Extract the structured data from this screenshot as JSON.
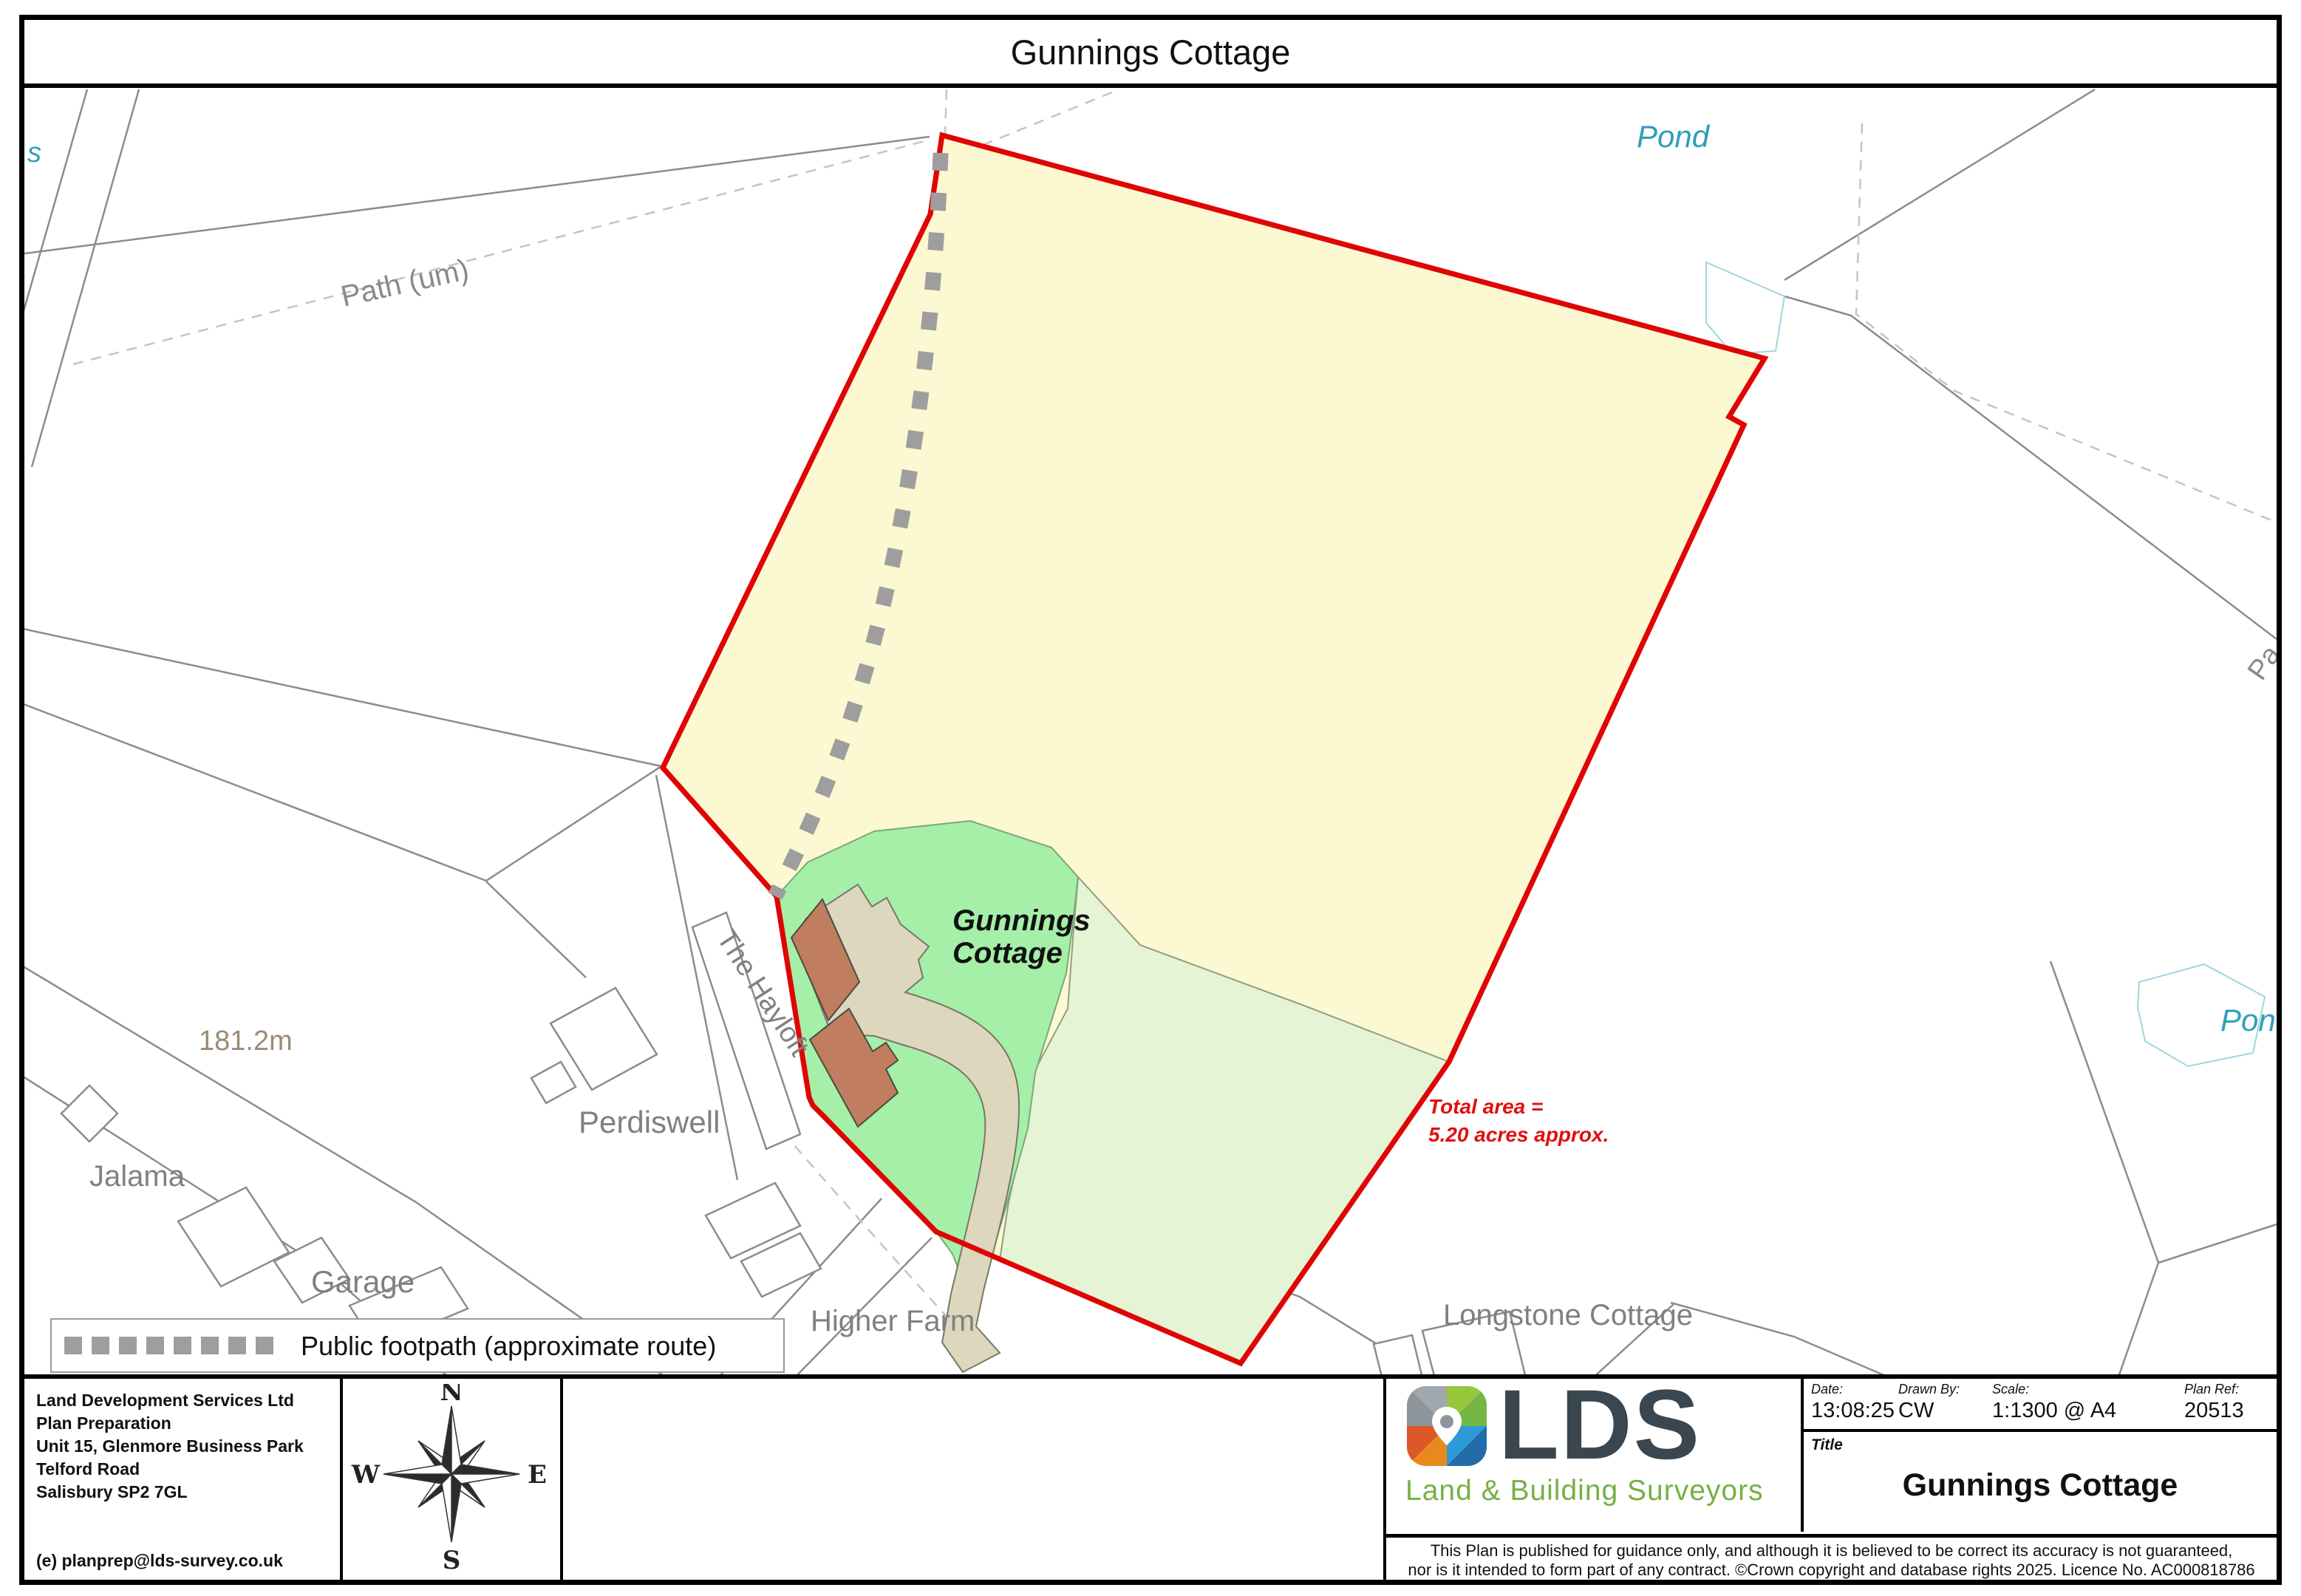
{
  "page": {
    "title": "Gunnings Cottage"
  },
  "map": {
    "labels": {
      "pond_top": "Pond",
      "pond_right": "Pond",
      "path_um": "Path (um)",
      "partial_s": "s",
      "partial_pa": "Pa",
      "spot_height": "181.2m",
      "jalama": "Jalama",
      "garage": "Garage",
      "perdiswell": "Perdiswell",
      "the_hayloft": "The Hayloft",
      "higher_farm": "Higher Farm",
      "longstone": "Longstone Cottage",
      "site_line1": "Gunnings",
      "site_line2": "Cottage",
      "total_area_line1": "Total area =",
      "total_area_line2": "5.20 acres approx."
    },
    "legend": {
      "text": "Public footpath (approximate route)"
    },
    "colors": {
      "boundary_red": "#e00505",
      "field_yellow": "#fbf8d2",
      "paddock_green": "#e4f4d4",
      "garden_green": "#a5efa9",
      "building_beige": "#dcd7bd",
      "building_terracotta": "#c07d5f",
      "pond_teal": "#2e9fb8",
      "area_text_red": "#e01010",
      "lds_navy": "#3a4750",
      "lds_green": "#76b043"
    }
  },
  "footer": {
    "company_lines": [
      "Land Development Services Ltd",
      "Plan Preparation",
      "Unit 15, Glenmore Business Park",
      "Telford Road",
      "Salisbury SP2 7GL"
    ],
    "email": "(e) planprep@lds-survey.co.uk",
    "compass": {
      "n": "N",
      "e": "E",
      "s": "S",
      "w": "W"
    },
    "logo": {
      "text": "LDS",
      "tagline": "Land & Building Surveyors"
    },
    "meta": {
      "date_label": "Date:",
      "date_value": "13:08:25",
      "drawn_label": "Drawn By:",
      "drawn_value": "CW",
      "scale_label": "Scale:",
      "scale_value": "1:1300 @ A4",
      "ref_label": "Plan Ref:",
      "ref_value": "20513"
    },
    "title_label": "Title",
    "title_value": "Gunnings Cottage",
    "disclaimer_line1": "This Plan is published for guidance only, and although it is believed to be correct its accuracy is not guaranteed,",
    "disclaimer_line2": "nor is it intended to form part of any contract. ©Crown copyright and database rights 2025. Licence No. AC000818786"
  }
}
